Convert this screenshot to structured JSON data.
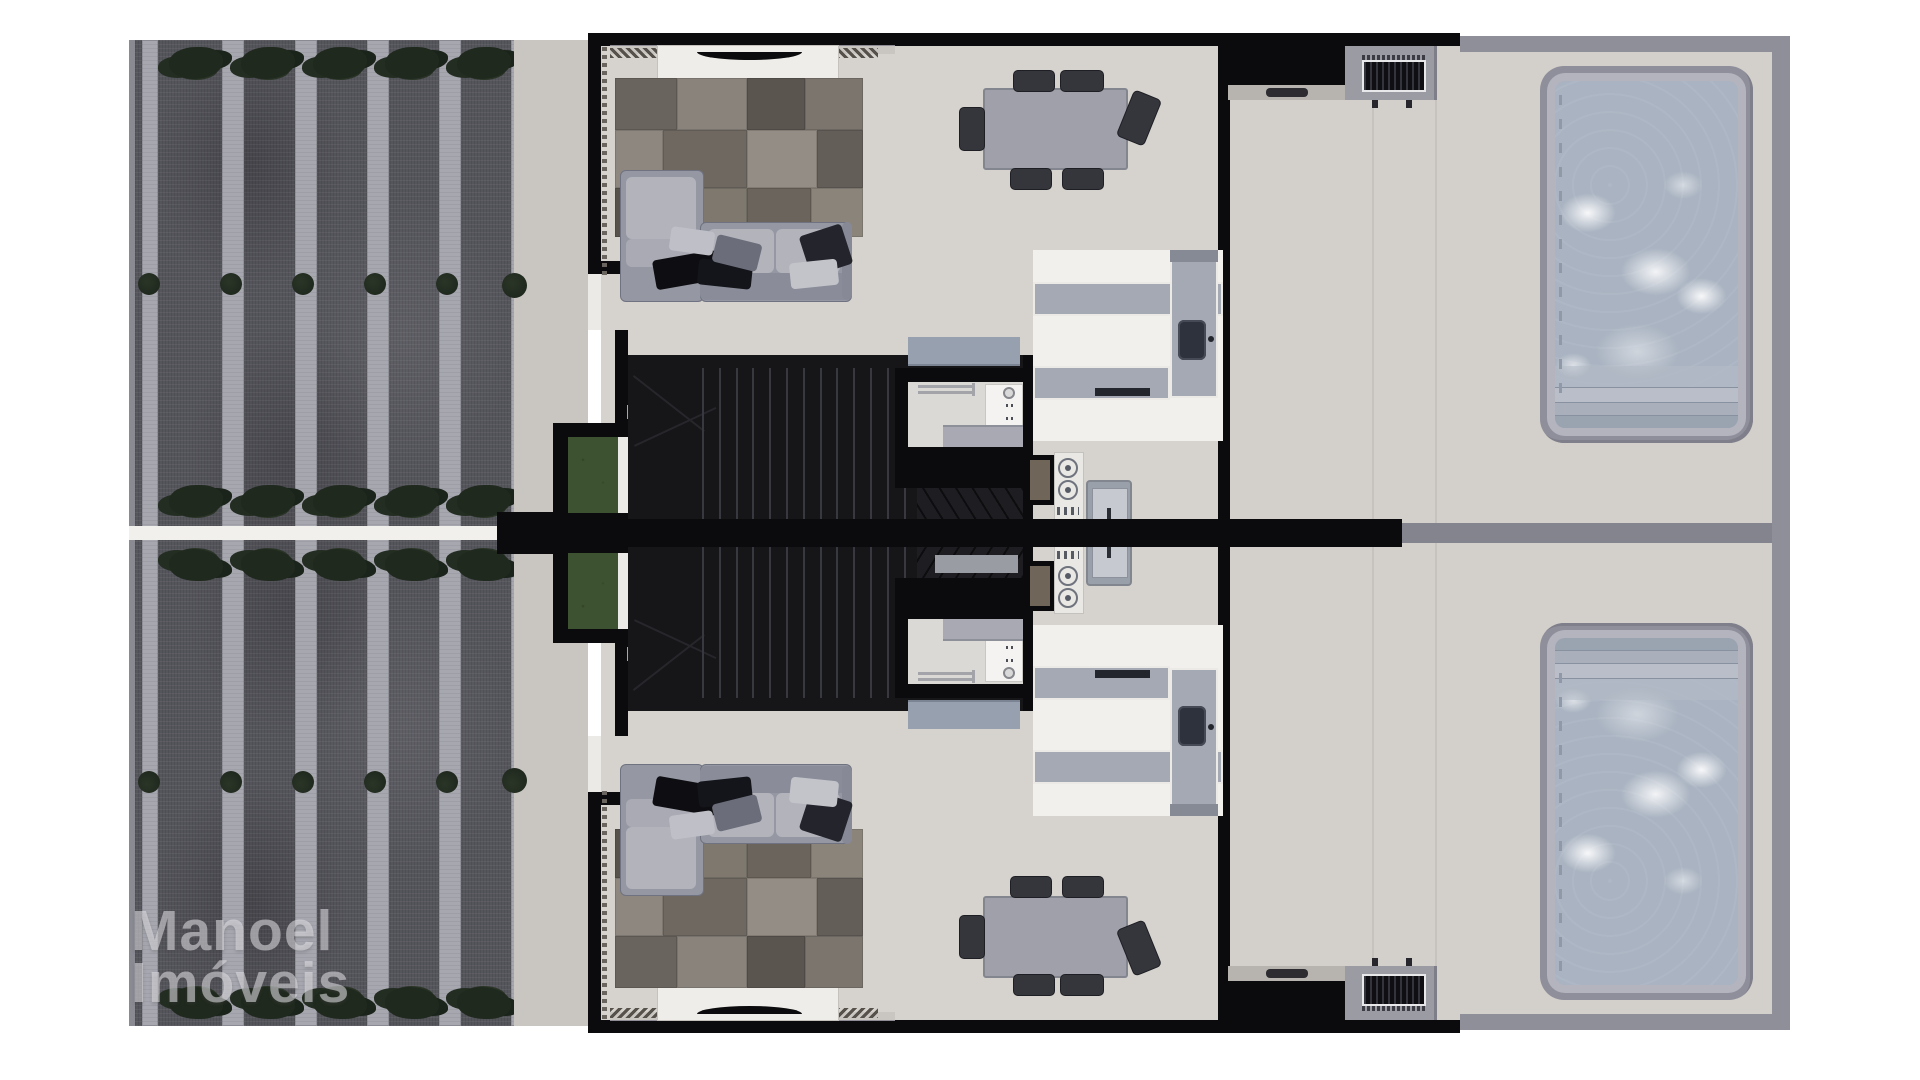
{
  "watermark": {
    "line1": "Manoel",
    "line2": "Imóveis"
  },
  "palette": {
    "floor": "#d6d2cd",
    "patio": "#d3cfca",
    "wallBlack": "#0b0b0d",
    "wallGray": "#8f8f9a",
    "sidewalk": "#c9c6c2",
    "driveDark": "#55555c",
    "driveStripe": "#a7a7b0",
    "greenDark": "#20291e",
    "planterGreen": "#3d5230",
    "whiteFloor": "#f2f0ed",
    "counter": "#a5a9b3",
    "counterSill": "#868a95",
    "rugBase": "#6f6962",
    "sofa": "#9598a3",
    "cushion": "#b2b3bb",
    "pillowDark": "#0e0e12",
    "table": "#9fa0a9",
    "chair": "#35363c",
    "stairs": "#161619",
    "tread": "#383840",
    "understair": "#1e1e22",
    "coping": "#8f8f9b",
    "copingRing": "#b4b4bf",
    "water": "#a9b3c1",
    "divider": "#84848e",
    "sill": "#b7b4af",
    "acFrame": "#9b9ba4",
    "acGrill": "#101013",
    "applianceWhite": "#e9e8e5",
    "ovenFace": "#6f6659",
    "washer": "#9aa0aa",
    "washerInner": "#c6c9cf",
    "bathFloor": "#dbd9d6",
    "sideboard": "#97a0af",
    "vanity": "#a8a9b2",
    "doorWhite": "#f4f3f1",
    "threshold": "#eceae6",
    "walkWhite": "#f2f0ed",
    "watermarkColor": "rgba(228,228,232,0.55)"
  },
  "driveway": {
    "stripes": [
      [
        7,
        16
      ],
      [
        87,
        22
      ],
      [
        160,
        22
      ],
      [
        232,
        22
      ],
      [
        304,
        22
      ],
      [
        376,
        9
      ]
    ],
    "bush_xs": [
      14,
      96,
      168,
      240,
      312,
      384
    ],
    "bush_row_y": 244,
    "tree_xs": [
      61,
      133,
      205,
      277,
      349
    ],
    "tree_rows_y": [
      23,
      461
    ]
  },
  "sidewalk_bush": {
    "x": 392,
    "y": 240
  },
  "rug": {
    "patches": [
      [
        0,
        0,
        62,
        52,
        "#6a645e"
      ],
      [
        62,
        0,
        70,
        52,
        "#89837c"
      ],
      [
        132,
        0,
        58,
        52,
        "#5b554f"
      ],
      [
        190,
        0,
        58,
        52,
        "#7b756e"
      ],
      [
        0,
        52,
        48,
        58,
        "#8d8780"
      ],
      [
        48,
        52,
        84,
        58,
        "#6e6861"
      ],
      [
        132,
        52,
        70,
        58,
        "#938d85"
      ],
      [
        202,
        52,
        46,
        58,
        "#645e58"
      ],
      [
        0,
        110,
        70,
        49,
        "#57524c"
      ],
      [
        70,
        110,
        62,
        49,
        "#7e786f"
      ],
      [
        132,
        110,
        64,
        49,
        "#6a645c"
      ],
      [
        196,
        110,
        52,
        49,
        "#8a847b"
      ]
    ]
  },
  "sofa": {
    "parts": [
      [
        510,
        137,
        82,
        130,
        "#9598a3",
        "#6f7280"
      ],
      [
        590,
        189,
        150,
        78,
        "#9598a3",
        "#6f7280"
      ],
      [
        516,
        144,
        70,
        62,
        "#b2b3bb",
        ""
      ],
      [
        516,
        206,
        70,
        28,
        "#a9aab3",
        ""
      ],
      [
        598,
        196,
        66,
        44,
        "#b2b3bb",
        ""
      ],
      [
        666,
        196,
        64,
        44,
        "#b2b3bb",
        ""
      ],
      [
        590,
        240,
        150,
        27,
        "#8a8d99",
        ""
      ],
      [
        732,
        189,
        10,
        78,
        "#878a96",
        ""
      ]
    ],
    "pillows": [
      [
        544,
        222,
        64,
        30,
        -10,
        "#0e0e12"
      ],
      [
        588,
        228,
        54,
        26,
        6,
        "#14151b"
      ],
      [
        604,
        206,
        46,
        28,
        14,
        "#6b6e7a"
      ],
      [
        694,
        196,
        44,
        42,
        -18,
        "#23242c"
      ],
      [
        680,
        228,
        48,
        26,
        -6,
        "#c3c4ca"
      ],
      [
        560,
        196,
        44,
        24,
        8,
        "#bfc0c7"
      ]
    ]
  },
  "stairs": {
    "tread_count": 13,
    "tread_x0": 74,
    "tread_dx": 16.8,
    "tread_y": 13,
    "tread_h": 165
  },
  "dining": {
    "chairs": [
      [
        903,
        37,
        40,
        20,
        0
      ],
      [
        950,
        37,
        42,
        20,
        0
      ],
      [
        900,
        135,
        40,
        20,
        0
      ],
      [
        952,
        135,
        40,
        20,
        0
      ],
      [
        849,
        74,
        24,
        42,
        0
      ],
      [
        1014,
        60,
        28,
        48,
        22
      ]
    ]
  },
  "pool": {
    "ticks": {
      "count": 13,
      "x": 4,
      "y0": 14,
      "dy": 24
    },
    "steps": [
      [
        0,
        "12px",
        "#9aa3b0"
      ],
      [
        13,
        "12px",
        "#a9b0bc"
      ],
      [
        26,
        "14px",
        "#b9bec8"
      ]
    ]
  },
  "burners": [
    [
      948,
      425
    ],
    [
      948,
      447
    ]
  ],
  "ac_legs": [
    1262,
    1296
  ],
  "joints": [
    1262,
    1325
  ],
  "zigzags": [
    [
      500,
      47
    ],
    [
      726,
      42
    ]
  ],
  "toilet_dots": [
    [
      896,
      371
    ],
    [
      896,
      384
    ]
  ],
  "rails_y": [
    352,
    358
  ]
}
